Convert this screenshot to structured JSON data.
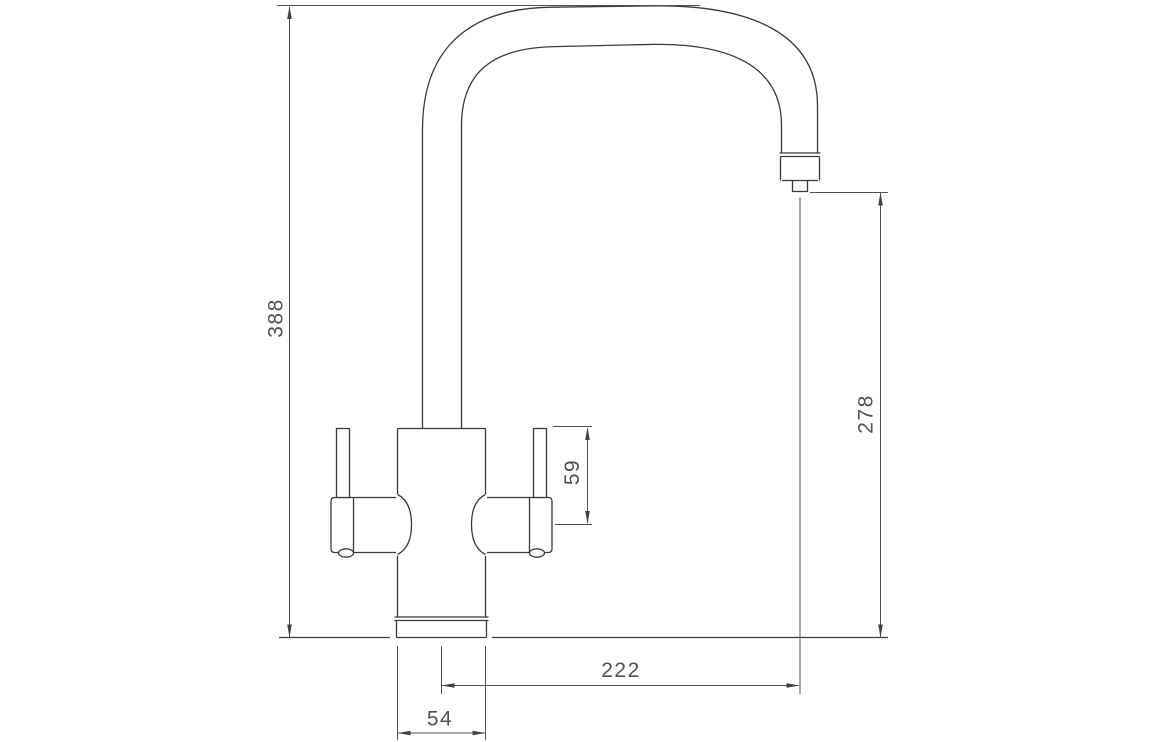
{
  "dimensions": {
    "overall_height": "388",
    "spout_outlet_height": "278",
    "handle_height": "59",
    "spout_projection": "222",
    "body_width": "54"
  },
  "colors": {
    "background": "#ffffff",
    "object_lines": "#3b3b3b",
    "dimension_lines": "#525252",
    "text": "#525252"
  }
}
